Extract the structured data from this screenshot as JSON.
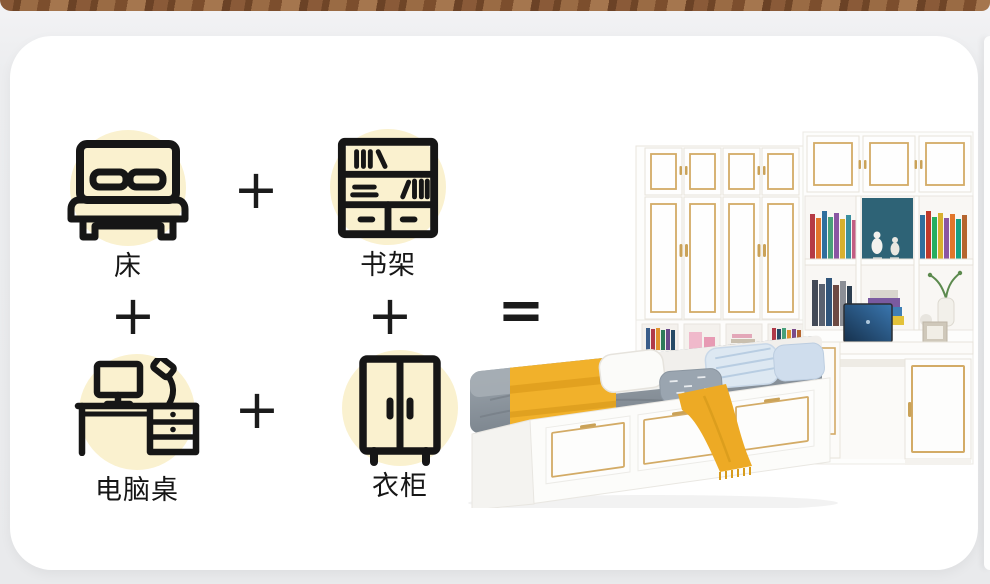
{
  "equation": {
    "terms": [
      {
        "id": "bed",
        "label": "床"
      },
      {
        "id": "bookshelf",
        "label": "书架"
      },
      {
        "id": "computer-desk",
        "label": "电脑桌"
      },
      {
        "id": "wardrobe",
        "label": "衣柜"
      }
    ],
    "plus_sign": "+",
    "equals_sign": "="
  },
  "colors": {
    "page_background": "#ecedef",
    "card_background": "#ffffff",
    "wood_strip": "#7d5130",
    "accent_circle": "#faf1cf",
    "icon_stroke": "#161616",
    "furniture_white": "#fdfdfc",
    "gold_trim": "#d3ab66",
    "mattress_gray": "#8b949c",
    "blanket_yellow": "#f1b12b",
    "laptop_screen_blue": "#2b5e8f"
  }
}
